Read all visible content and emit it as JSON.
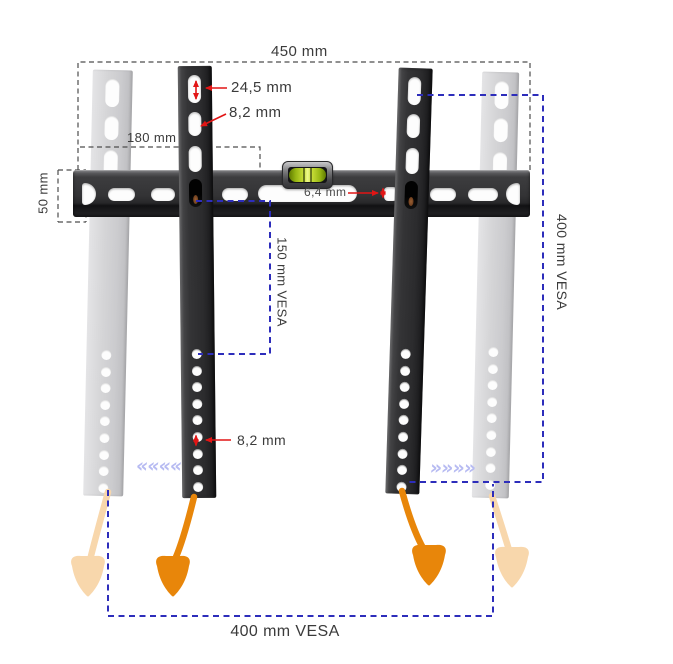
{
  "diagram": {
    "dim_width_total": "450 mm",
    "dim_slot_length": "24,5 mm",
    "dim_slot_width": "8,2 mm",
    "dim_wall_plate_width": "180 mm",
    "dim_rail_height": "50 mm",
    "dim_rail_slot": "6,4 mm",
    "dim_vesa_150": "150 mm VESA",
    "dim_vesa_400_vertical": "400 mm VESA",
    "dim_hole_diameter": "8,2 mm",
    "dim_vesa_400_horizontal": "400 mm VESA",
    "chevrons_left": "««««",
    "chevrons_right": "»»»»"
  },
  "colors": {
    "dimension_blue": "#2d2dbb",
    "dimension_gray": "#4d4d4d",
    "annotation_red": "#e21515",
    "strap_orange": "#e8860a",
    "strap_orange_faded": "#f8d7ac",
    "chevron_lilac": "#b7bbf2",
    "level_green": "#c8dd37",
    "bracket_dark": "#2e2e30",
    "bracket_ghost": "#d2d2d4"
  }
}
